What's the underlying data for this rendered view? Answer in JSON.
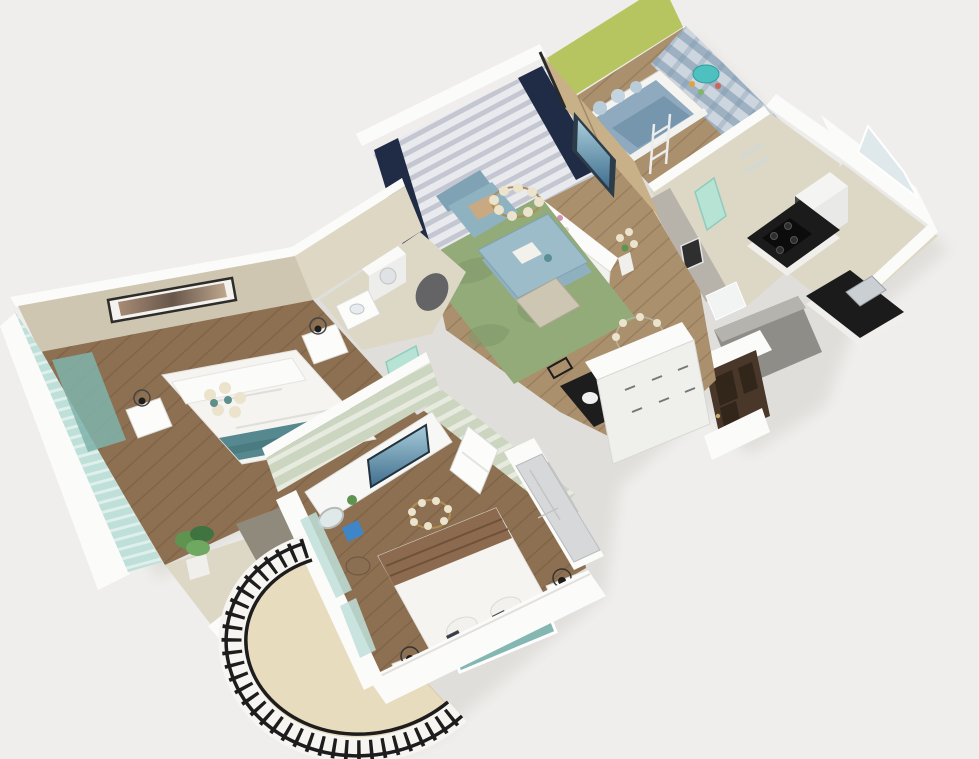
{
  "scene": {
    "type": "3d-apartment-floor-plan-render",
    "view": "isometric cutaway, no visible text",
    "background": "#efeeec",
    "rooms": [
      {
        "name": "kids-room",
        "position": "top-right",
        "features": [
          "green-accent-wall",
          "plaid-curtain-wall",
          "bunk-bed",
          "bed-ladder",
          "teal-play-table"
        ],
        "wall_color_key": "green_wall"
      },
      {
        "name": "living-dining-room",
        "position": "center",
        "features": [
          "sheer-curtain-wall",
          "navy-drapes",
          "wood-tv-wall",
          "wall-tv",
          "tv-cabinet",
          "blue-armchair",
          "blue-coffee-table",
          "green-rug",
          "chandelier",
          "bench",
          "ring-chandelier",
          "black-dining-table",
          "dining-chairs",
          "flower-vase"
        ],
        "floor_color_key": "floor_wood"
      },
      {
        "name": "kitchen",
        "position": "right",
        "features": [
          "window-wall",
          "l-shaped-counter",
          "black-countertop",
          "gas-stove",
          "sink",
          "fridge",
          "gray-exterior-wall"
        ],
        "floor_color_key": "floor_tile"
      },
      {
        "name": "hallway-bath",
        "position": "center-right",
        "features": [
          "mint-glass-door",
          "white-door",
          "gray-wall-art",
          "shower-glass"
        ],
        "floor_color_key": "floor_tile"
      },
      {
        "name": "entry",
        "position": "right-lower",
        "features": [
          "brown-front-door",
          "white-sideboard"
        ]
      },
      {
        "name": "master-bedroom",
        "position": "left",
        "features": [
          "beige-walls",
          "wall-art",
          "double-bed",
          "teal-throw",
          "nightstands",
          "wire-lamps",
          "flower-chandelier",
          "teal-window-wall",
          "potted-plant",
          "desk-nook",
          "gray-rug"
        ],
        "floor_color_key": "floor_wood_dark"
      },
      {
        "name": "laundry-bath",
        "position": "center-left",
        "features": [
          "washing-machine",
          "vanity-sink",
          "mint-door",
          "shower"
        ],
        "floor_color_key": "floor_tile"
      },
      {
        "name": "second-bedroom",
        "position": "bottom-center",
        "features": [
          "sage-curtain-wall",
          "sage-door-wall",
          "white-door",
          "desk-tv-cabinet",
          "desk-tv",
          "round-mirror",
          "blue-box",
          "wood-stool",
          "gold-chandelier",
          "double-bed",
          "brown-runner",
          "teal-headboard",
          "nightstands",
          "wire-lamps",
          "sliding-door-wardrobe"
        ],
        "floor_color_key": "floor_wood_dark"
      },
      {
        "name": "balcony",
        "position": "bottom-left",
        "features": [
          "curved-black-railing",
          "tile-floor"
        ],
        "floor_color_key": "balcony_tile"
      }
    ]
  },
  "palette": {
    "bg": "#efeeec",
    "wall_white": "#fbfbf9",
    "wall_edge": "#dedcd7",
    "wall_gray": "#b7b3ab",
    "wall_beige": "#cfc6b2",
    "beige_light": "#ded7c4",
    "floor_wood": "#ab906e",
    "floor_wood_dark": "#8d7051",
    "floor_tile": "#ddd7c5",
    "balcony_tile": "#e8dcbe",
    "green_wall": "#b6c55f",
    "sage": "#ccd5bf",
    "navy": "#202c45",
    "sofa_blue": "#8fb2c1",
    "coffee_blue": "#9cbcca",
    "rug_green": "#93aa79",
    "rug_gray": "#8f8a7c",
    "wood_panel": "#c8b089",
    "tv_dark": "#2d3c49",
    "teal": "#55898f",
    "teal_glass": "#bfdfd9",
    "mint": "#b7e3d5",
    "bed_white": "#f5f4f1",
    "brown_runner": "#8b6a4f",
    "door_brown": "#49372a",
    "counter_black": "#1b1b1b",
    "black": "#1d1d1d",
    "gold": "#b08d55",
    "cream": "#ebe3cc",
    "plant_green": "#5f9350",
    "gray_block": "#8f8d88",
    "shadow_c": "#d8d6d1"
  }
}
